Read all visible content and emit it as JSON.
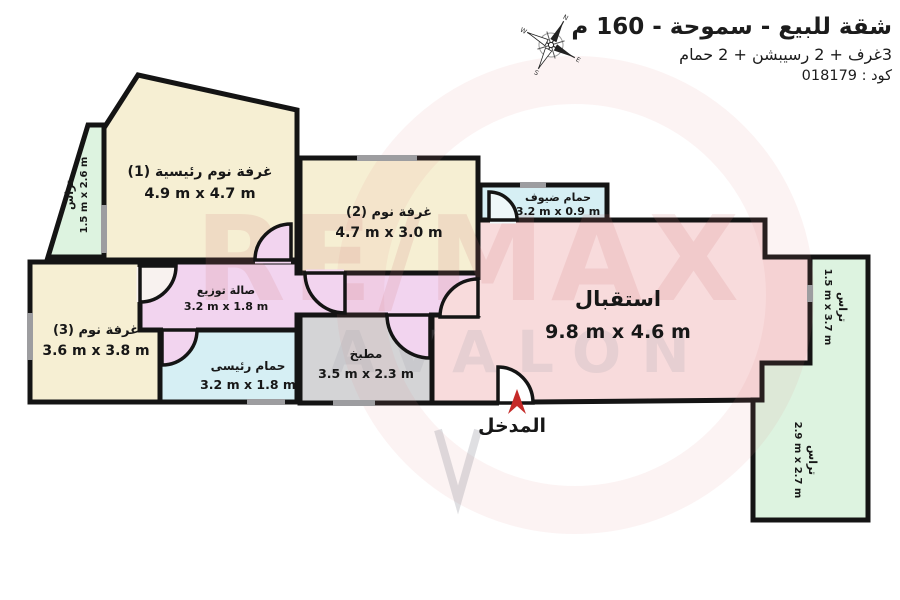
{
  "header": {
    "title": "شقة للبيع - سموحة - 160 م",
    "subtitle": "3غرف + 2 رسيبشن + 2 حمام",
    "code": "كود : 018179"
  },
  "compass": {
    "n": "N",
    "e": "E",
    "s": "S",
    "w": "W"
  },
  "watermark": {
    "line1": "RE/MAX",
    "line2": "AVALON"
  },
  "entrance": {
    "label": "المدخل"
  },
  "rooms": {
    "master_bedroom": {
      "label": "غرفة نوم رئيسية (1)",
      "dims": "4.9 m x 4.7 m"
    },
    "bedroom2": {
      "label": "غرفة نوم (2)",
      "dims": "4.7 m x 3.0 m"
    },
    "bedroom3": {
      "label": "غرفة نوم (3)",
      "dims": "3.6 m x 3.8 m"
    },
    "hall": {
      "label": "صالة توزيع",
      "dims": "3.2 m x 1.8 m"
    },
    "master_bathroom": {
      "label": "حمام رئيسى",
      "dims": "3.2 m x 1.8 m"
    },
    "kitchen": {
      "label": "مطبخ",
      "dims": "3.5 m x 2.3 m"
    },
    "guest_bathroom": {
      "label": "حمام ضيوف",
      "dims": "3.2 m x 0.9 m"
    },
    "reception": {
      "label": "استقبال",
      "dims": "9.8 m x 4.6 m"
    },
    "terrace_left": {
      "label": "تراس",
      "dims": "1.5 m x 2.6 m"
    },
    "terrace_right": {
      "label": "تراس",
      "dims": "1.5 m x 3.7 m"
    },
    "terrace_bottom": {
      "label": "تراس",
      "dims": "2.9 m x 2.7 m"
    }
  },
  "colors": {
    "wall": "#141414",
    "bedroom_fill": "#f6efd3",
    "terrace_fill": "#ddf3e0",
    "reception_fill": "#f8dbdc",
    "hall_fill": "#f2d4ef",
    "bathroom_fill": "#d6eff4",
    "kitchen_fill": "#d4d4d6",
    "window": "#9d9da0",
    "entrance_arrow": "#c52a28"
  }
}
